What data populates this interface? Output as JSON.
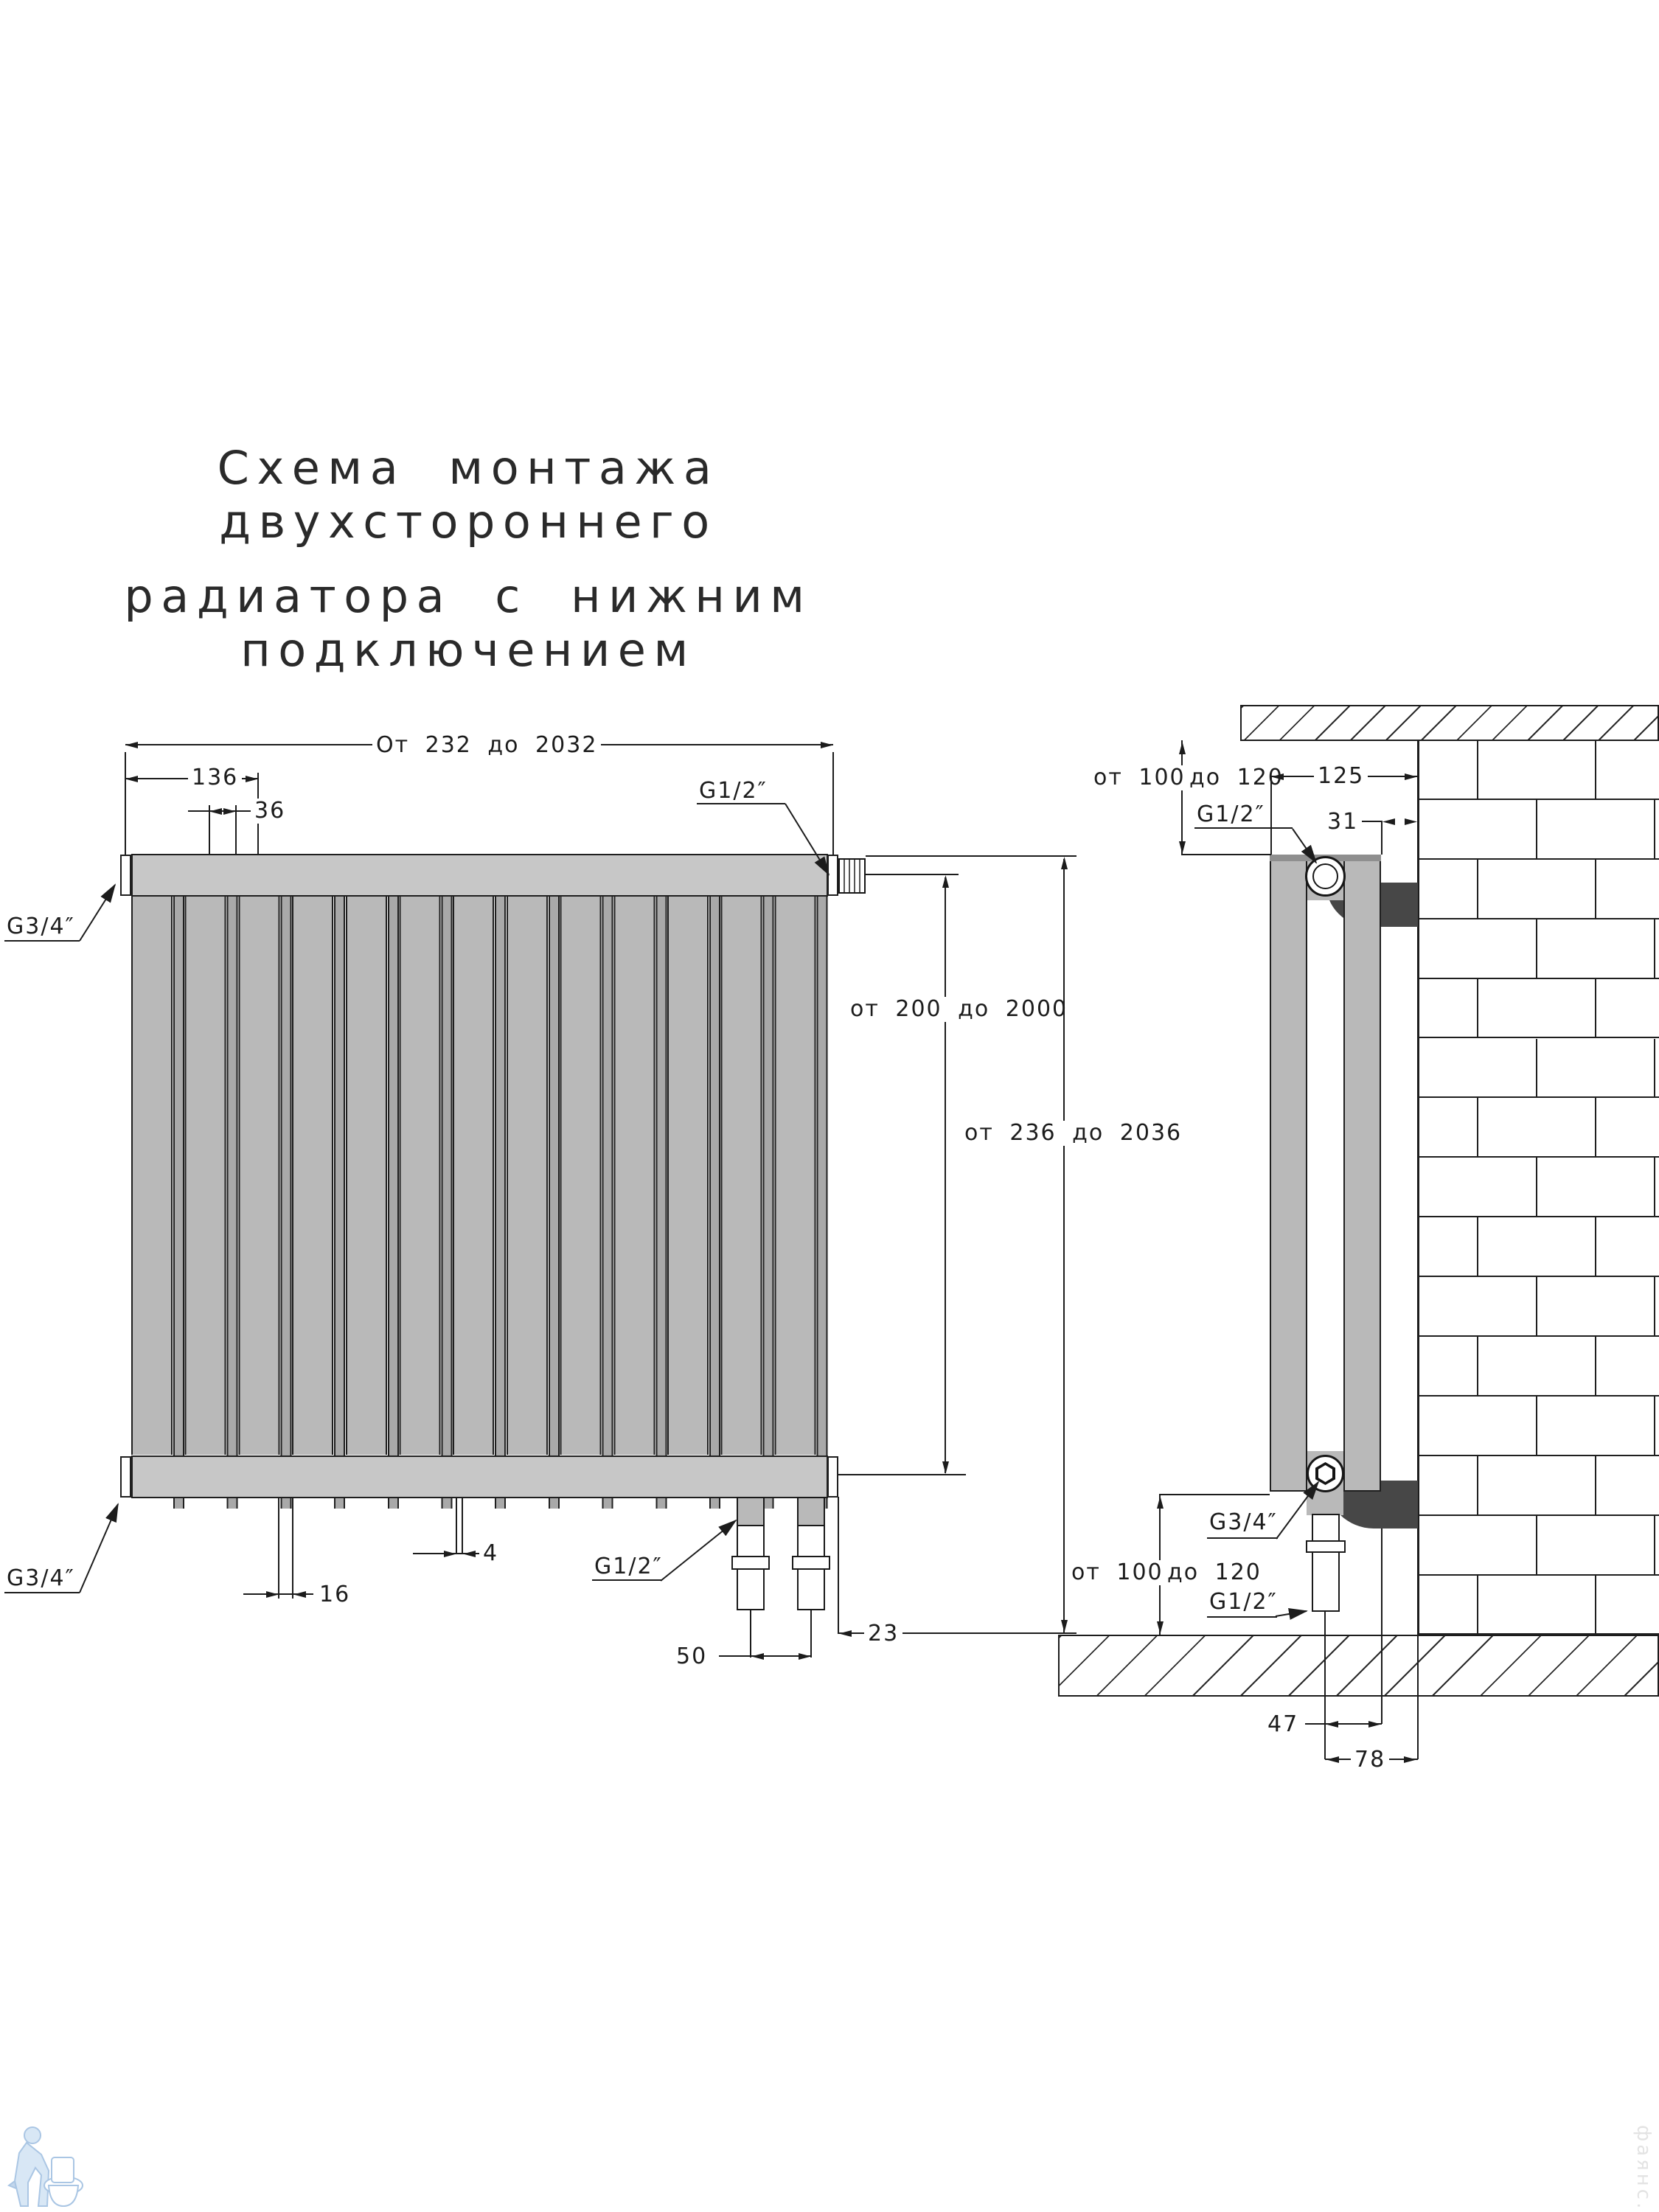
{
  "title": {
    "line1": "Схема монтажа двухстороннего",
    "line2": "радиатора с нижним подключением"
  },
  "colors": {
    "line": "#1c1c1c",
    "section_gray": "#b9b9b9",
    "header_gray": "#c7c7c7",
    "dark_fitting": "#474747",
    "watermark_blue": "#c9ddf0"
  },
  "front_view": {
    "section_count": 13,
    "dim_overall_width": "От 232 до 2032",
    "dim_left_group": "136",
    "dim_section_step": "36",
    "label_top_left": "G3/4″",
    "label_top_right": "G1/2″",
    "dim_height_sections": "от 200 до 2000",
    "dim_height_total": "от 236 до 2036",
    "label_bottom_left": "G3/4″",
    "label_bottom_pipes": "G1/2″",
    "dim_gap": "16",
    "dim_small_gap": "4",
    "dim_pipe_spacing": "50",
    "dim_pipe_to_edge": "23"
  },
  "side_view": {
    "dim_top_gap_left": "от 100",
    "dim_top_gap_right": "до 120",
    "dim_depth": "125",
    "dim_wall_clearance": "31",
    "label_top_valve": "G1/2″",
    "label_bottom_valve": "G3/4″",
    "dim_bottom_gap_left": "от 100",
    "dim_bottom_gap_right": "до 120",
    "label_bottom_pipe": "G1/2″",
    "dim_pipe_to_bracket": "47",
    "dim_pipe_to_wall": "78"
  },
  "watermark": {
    "site_text": "фаянс.рф"
  }
}
